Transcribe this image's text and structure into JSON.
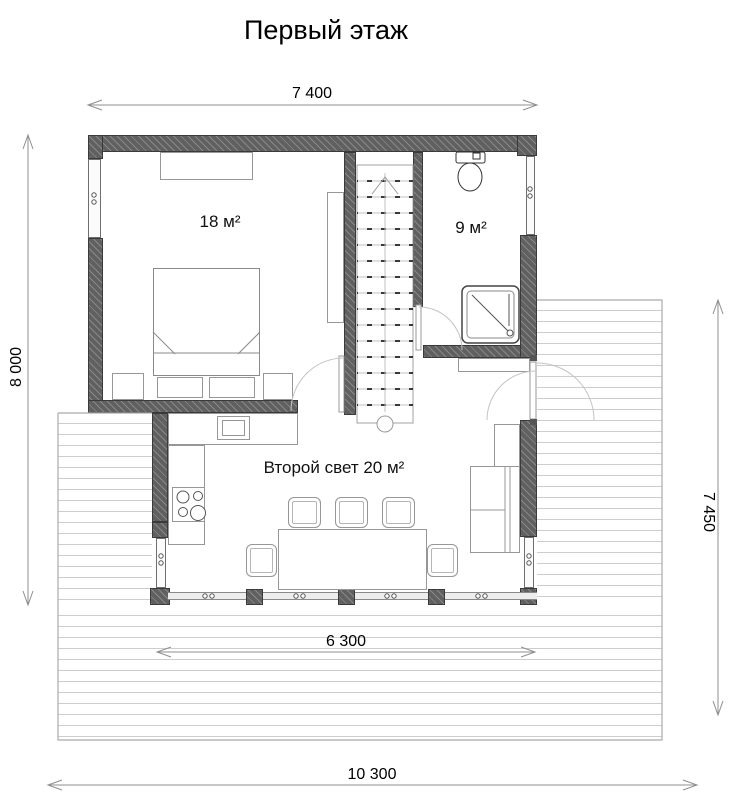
{
  "title": "Первый этаж",
  "dimensions": {
    "top": "7 400",
    "left": "8 000",
    "right": "7 450",
    "terrace": "6 300",
    "overall_bottom": "10 300"
  },
  "rooms": {
    "bedroom": {
      "label": "18 м²"
    },
    "bathroom": {
      "label": "9 м²"
    },
    "living_room": {
      "label": "Второй свет 20 м²"
    }
  },
  "symbols": [
    "wardrobe",
    "double-bed",
    "pillow",
    "nightstand",
    "cabinet",
    "staircase",
    "toilet",
    "shower-tray",
    "bathroom-cabinet",
    "kitchen-counter",
    "sink",
    "stove",
    "dining-table",
    "chair",
    "sofa",
    "door-swing",
    "window",
    "deck-boards",
    "dimension-arrow"
  ],
  "colors": {
    "wall": "#606060",
    "furniture_line": "#979797",
    "deck_line": "#cdcdcd",
    "dimension_line": "#8f8f8f",
    "text": "#111111"
  }
}
